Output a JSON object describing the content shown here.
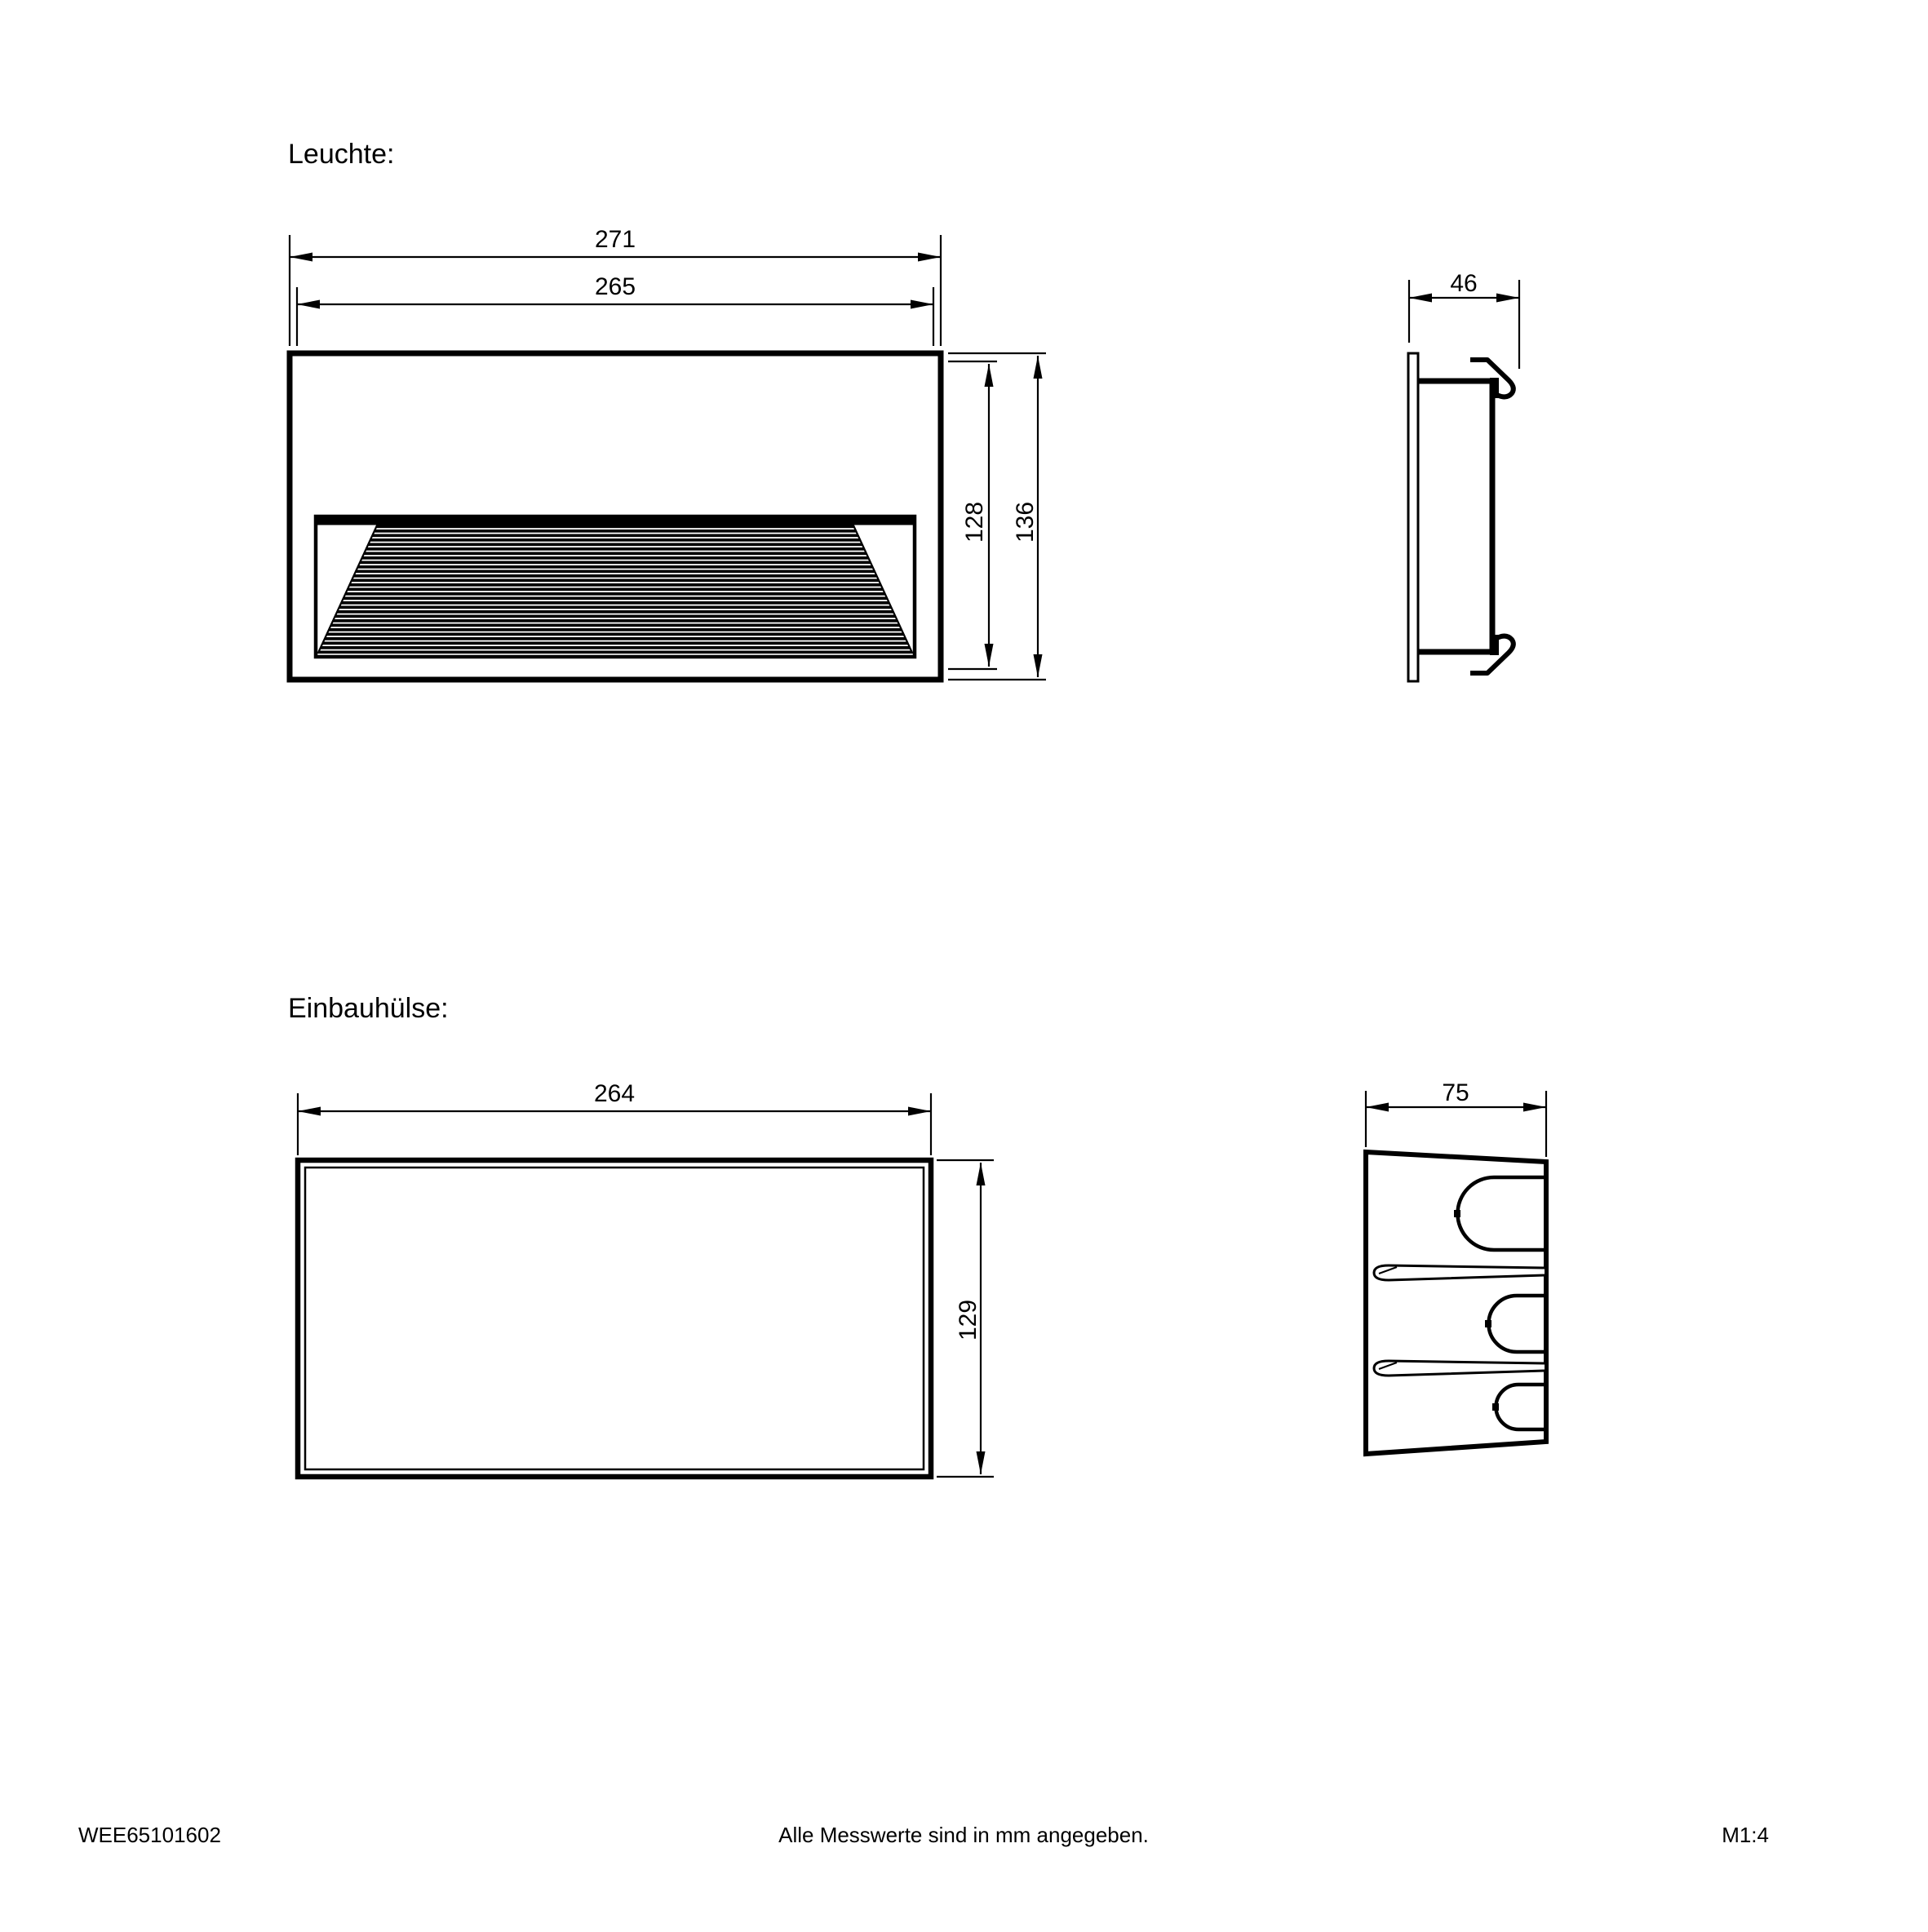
{
  "colors": {
    "ink": "#000000",
    "paper": "#ffffff"
  },
  "titles": {
    "luminaire": "Leuchte:",
    "sleeve": "Einbauhülse:"
  },
  "luminaire": {
    "front": {
      "width_outer": "271",
      "width_inner": "265",
      "height_inner": "128",
      "height_outer": "136"
    },
    "side": {
      "depth": "46"
    }
  },
  "sleeve": {
    "front": {
      "width": "264",
      "height": "129"
    },
    "side": {
      "depth": "75"
    }
  },
  "footer": {
    "doc_number": "WEE65101602",
    "note": "Alle Messwerte sind in mm angegeben.",
    "scale": "M1:4"
  }
}
